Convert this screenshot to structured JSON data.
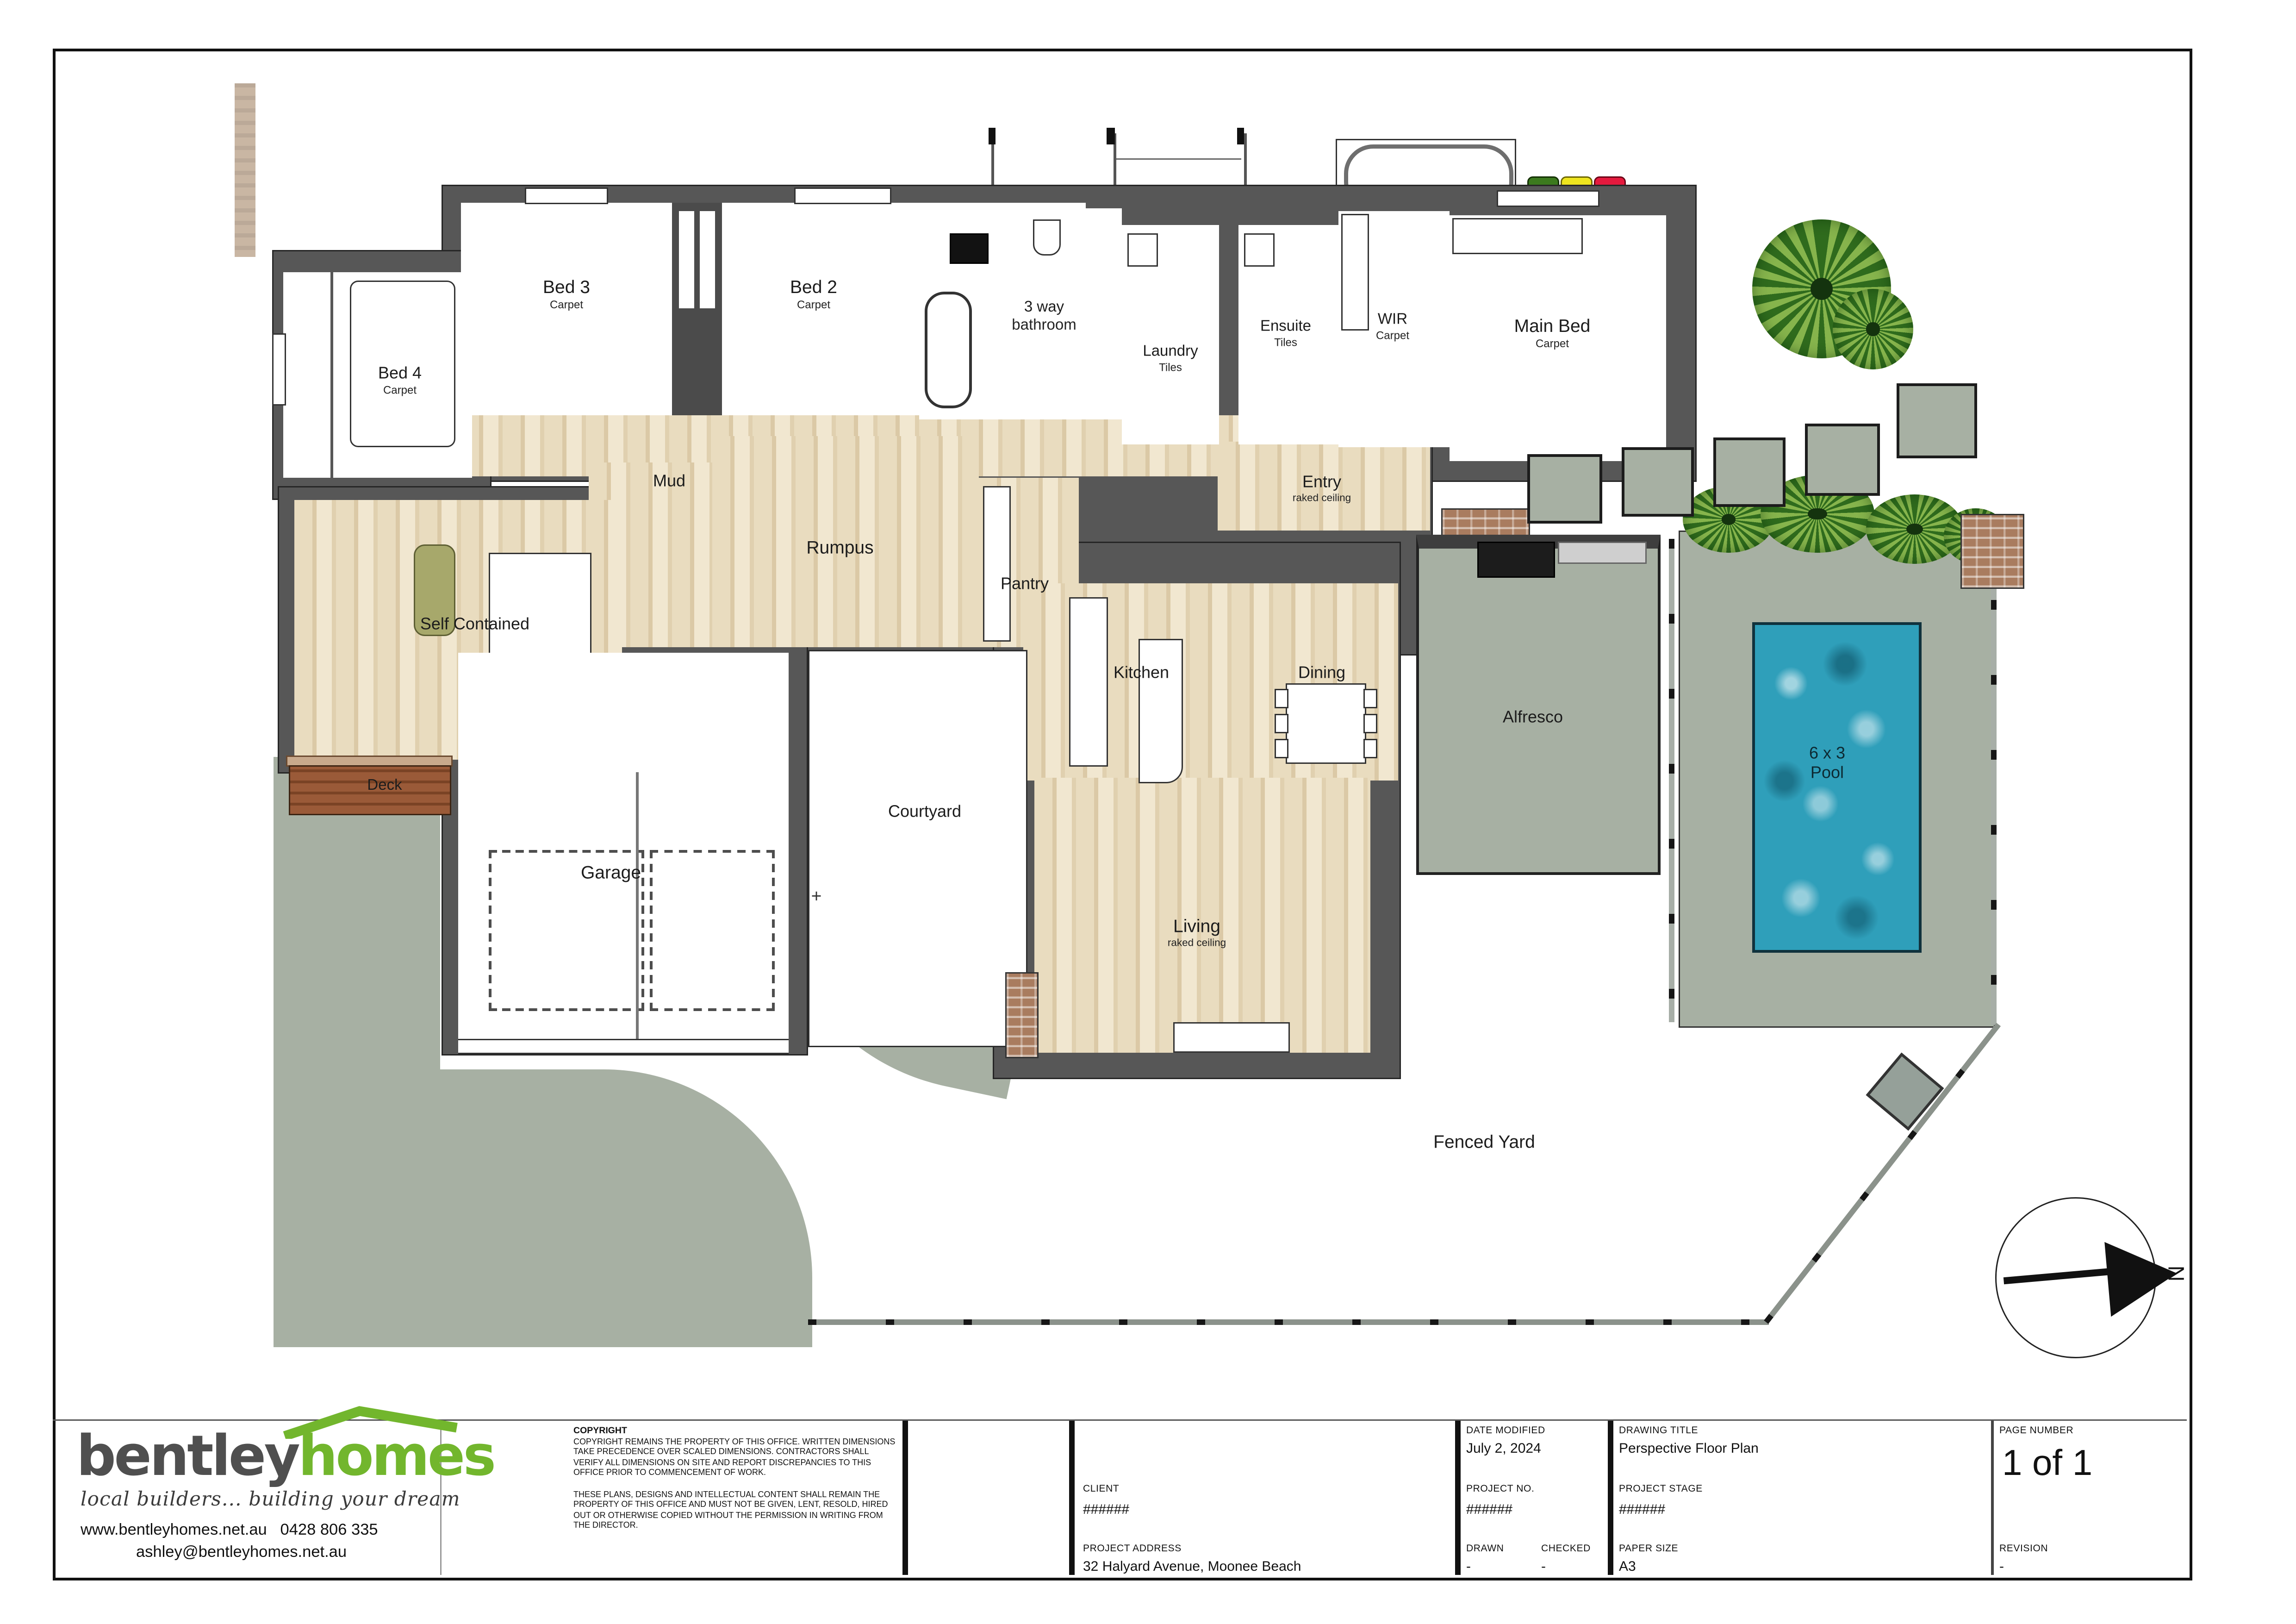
{
  "plan": {
    "rooms": {
      "bed3": {
        "label": "Bed 3",
        "sub": "Carpet"
      },
      "bed2": {
        "label": "Bed 2",
        "sub": "Carpet"
      },
      "bathroom3way": {
        "label": "3 way",
        "sub": "bathroom"
      },
      "laundry": {
        "label": "Laundry",
        "sub": "Tiles"
      },
      "ensuite": {
        "label": "Ensuite",
        "sub": "Tiles"
      },
      "wir": {
        "label": "WIR",
        "sub": "Carpet"
      },
      "mainbed": {
        "label": "Main Bed",
        "sub": "Carpet"
      },
      "bed4": {
        "label": "Bed 4",
        "sub": "Carpet"
      },
      "mud": {
        "label": "Mud"
      },
      "rumpus": {
        "label": "Rumpus"
      },
      "pantry": {
        "label": "Pantry"
      },
      "entry": {
        "label": "Entry",
        "sub": "raked ceiling"
      },
      "selfcontained": {
        "label": "Self Contained"
      },
      "kitchen": {
        "label": "Kitchen"
      },
      "dining": {
        "label": "Dining"
      },
      "living": {
        "label": "Living",
        "sub": "raked ceiling"
      },
      "alfresco": {
        "label": "Alfresco"
      },
      "pool": {
        "label": "6 x 3",
        "sub": "Pool"
      },
      "deck": {
        "label": "Deck"
      },
      "garage": {
        "label": "Garage"
      },
      "courtyard": {
        "label": "Courtyard"
      },
      "fenced_yard": {
        "label": "Fenced Yard"
      }
    },
    "symbols": {
      "north": "N",
      "courtyard_cross": "+"
    }
  },
  "title_block": {
    "logo": {
      "brand_part1": "bentley",
      "brand_part2": "homes",
      "tagline": "local builders... building your dream",
      "website": "www.bentleyhomes.net.au",
      "phone": "0428 806 335",
      "email": "ashley@bentleyhomes.net.au"
    },
    "copyright": {
      "heading": "COPYRIGHT",
      "para1": "COPYRIGHT REMAINS THE PROPERTY OF THIS OFFICE. WRITTEN DIMENSIONS TAKE PRECEDENCE OVER SCALED DIMENSIONS. CONTRACTORS SHALL VERIFY ALL DIMENSIONS ON SITE AND REPORT DISCREPANCIES TO THIS OFFICE PRIOR TO COMMENCEMENT OF WORK.",
      "para2": "THESE PLANS, DESIGNS AND INTELLECTUAL CONTENT SHALL REMAIN THE PROPERTY OF THIS OFFICE AND MUST NOT BE GIVEN, LENT, RESOLD, HIRED OUT OR OTHERWISE COPIED WITHOUT THE PERMISSION IN WRITING FROM THE DIRECTOR."
    },
    "client": {
      "label": "CLIENT",
      "value": "######"
    },
    "project_address": {
      "label": "PROJECT ADDRESS",
      "value": "32 Halyard Avenue, Moonee Beach"
    },
    "date_modified": {
      "label": "DATE MODIFIED",
      "value": "July 2, 2024"
    },
    "project_no": {
      "label": "PROJECT NO.",
      "value": "######"
    },
    "drawn": {
      "label": "DRAWN",
      "value": "-"
    },
    "checked": {
      "label": "CHECKED",
      "value": "-"
    },
    "drawing_title": {
      "label": "DRAWING TITLE",
      "value": "Perspective Floor Plan"
    },
    "project_stage": {
      "label": "PROJECT STAGE",
      "value": "######"
    },
    "paper_size": {
      "label": "PAPER SIZE",
      "value": "A3"
    },
    "page_number": {
      "label": "PAGE NUMBER",
      "value": "1 of 1"
    },
    "revision": {
      "label": "REVISION",
      "value": "-"
    }
  },
  "colors": {
    "accent_green": "#72b62d",
    "wall_grey": "#575757",
    "timber_floor": "#e7d9bd",
    "yard_concrete": "#a7b0a3",
    "pool_blue": "#2f9fba",
    "deck_brown": "#95532f",
    "brick": "#a97c5f",
    "bin_green": "#3c7a1e",
    "bin_yellow": "#efe51f",
    "bin_red": "#e51a3e",
    "sofa_olive": "#a7a86b"
  }
}
